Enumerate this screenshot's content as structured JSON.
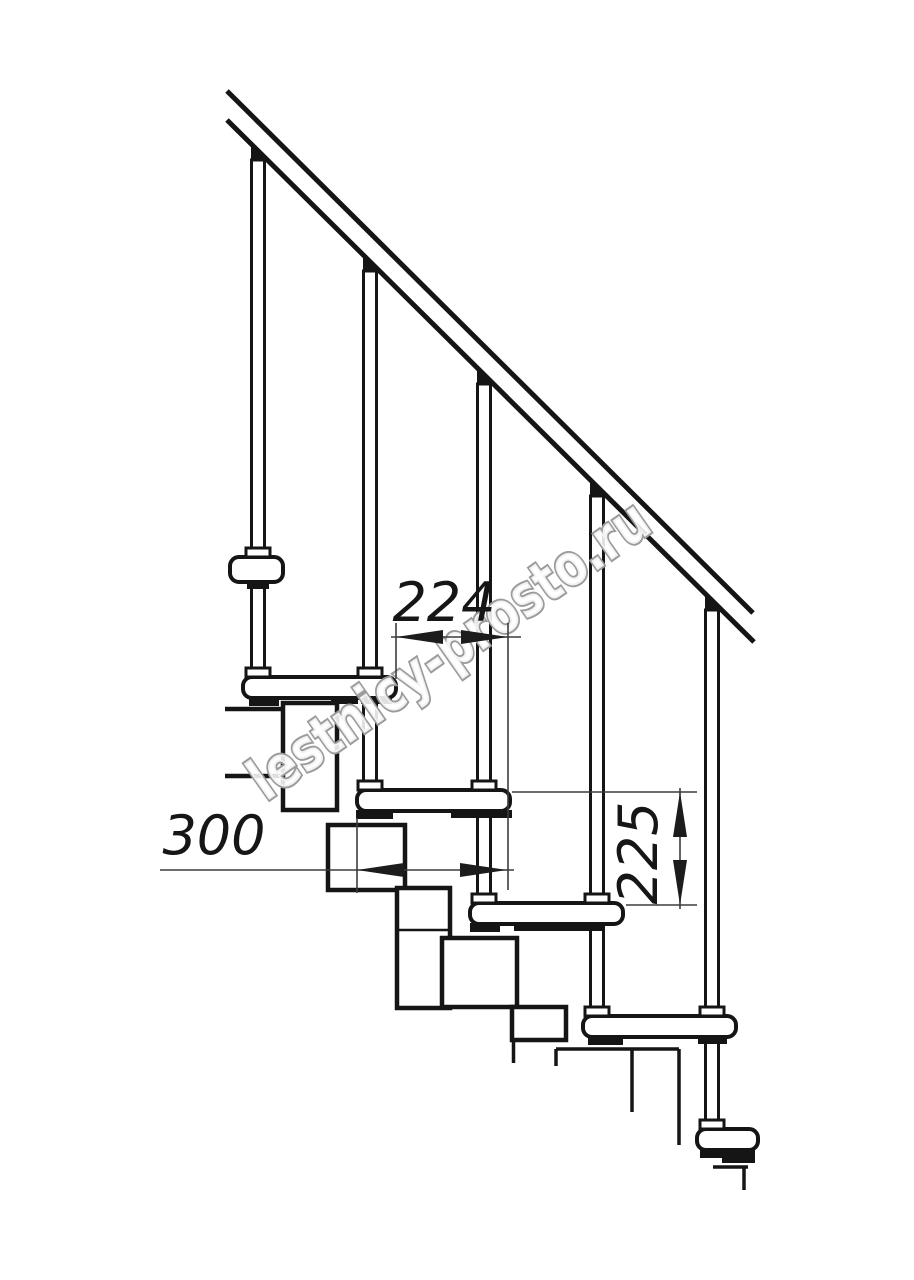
{
  "drawing": {
    "kind": "staircase-side-view-technical-drawing",
    "watermark_text": "lestnicy-prosto.ru",
    "dimensions": {
      "step_offset": {
        "value": "224",
        "orientation": "horizontal"
      },
      "tread_depth": {
        "value": "300",
        "orientation": "horizontal"
      },
      "riser_height": {
        "value": "225",
        "orientation": "vertical"
      }
    },
    "elements": {
      "balusters": 5,
      "treads_visible": 6,
      "handrail": "diagonal double line"
    },
    "colors": {
      "line": "#151515",
      "dimension_line": "#3d3d3d",
      "watermark_outline": "#9b9b9b",
      "background": "#ffffff"
    }
  }
}
